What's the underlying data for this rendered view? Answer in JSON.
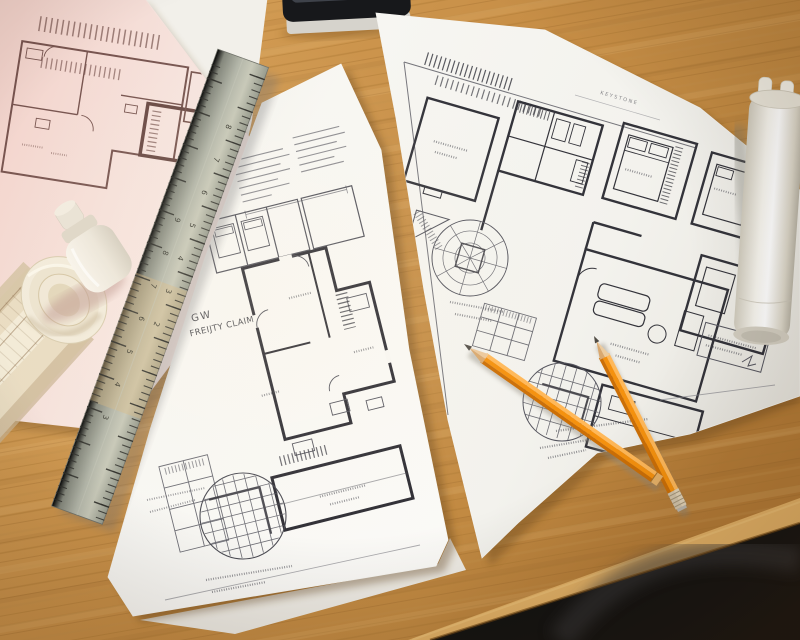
{
  "scene": {
    "subject": "Architectural floor-plan blueprints spread on a wooden drafting desk",
    "objects": [
      "pink blueprint sheet",
      "center blueprint sheet",
      "right blueprint sheet",
      "metal ruler",
      "orange pencil",
      "orange pencil with ferrule",
      "rolled blueprint",
      "white paper tube",
      "glue bottle",
      "stapler",
      "gold ornament"
    ]
  },
  "texts": {
    "center_sheet_title_line1": "GW",
    "center_sheet_title_line2": "FREIJTY CLAIM",
    "right_sheet_header_note": "KEYSTONE"
  },
  "ruler": {
    "numbers_right": [
      "8",
      "7",
      "6",
      "5",
      "4",
      "3",
      "2"
    ],
    "numbers_left": [
      "9",
      "8",
      "7",
      "6",
      "5",
      "4",
      "3"
    ]
  },
  "colors": {
    "wood_light": "#dcab63",
    "wood_mid": "#c9914a",
    "wood_dark": "#a87434",
    "desk_edge": "#e3b267",
    "floor_dark": "#131312",
    "paper_white": "#f8f7f3",
    "paper_cool": "#f5f4f0",
    "paper_pink": "#f5e2dc",
    "ink_dark": "#2f2e35",
    "ink_mid": "#55555e",
    "ink_pink": "#6b4742",
    "pencil_orange": "#f5910e",
    "pencil_highlight": "#ffb859",
    "pencil_shadow": "#cc6f06",
    "ruler_metal": "#aeb1a4",
    "tube_white": "#f7f5ee",
    "roll_cream": "#e9dcc2"
  }
}
